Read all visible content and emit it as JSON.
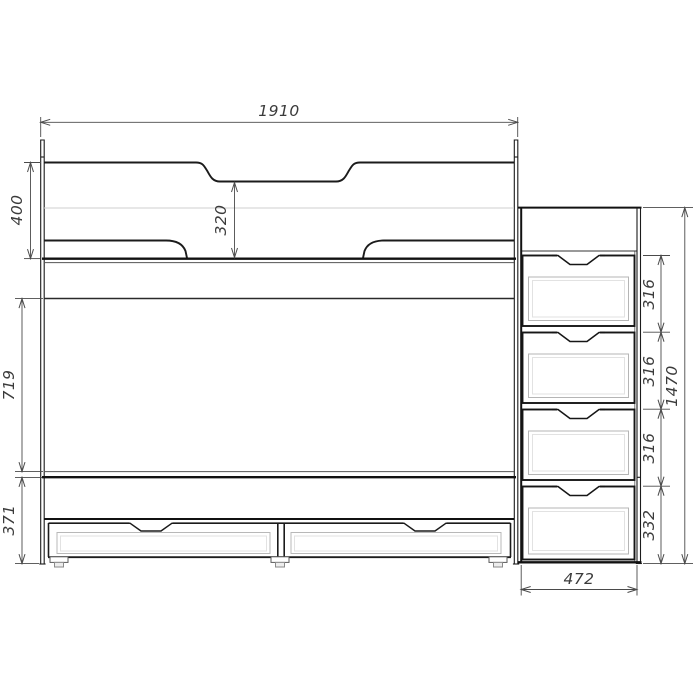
{
  "drawing": {
    "dims": {
      "overall_length": "1910",
      "headguard_height": "400",
      "guard_opening": "320",
      "bunk_clearance": "719",
      "base_height": "371",
      "stair_total_height": "1470",
      "stair_width": "472",
      "stair_steps": [
        {
          "label": "316"
        },
        {
          "label": "316"
        },
        {
          "label": "316"
        },
        {
          "label": "332"
        }
      ]
    }
  }
}
